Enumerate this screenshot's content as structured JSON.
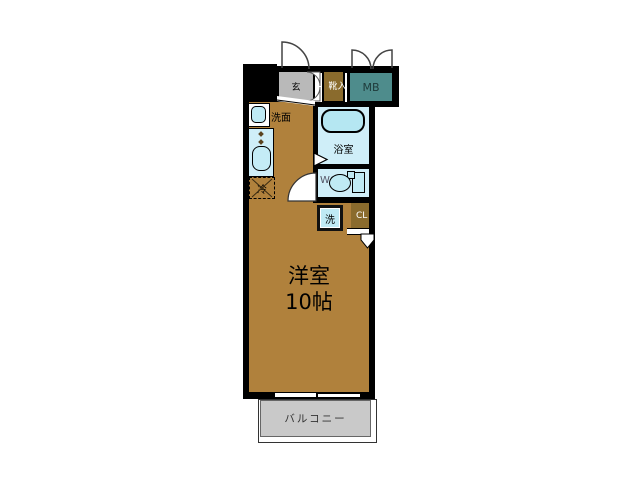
{
  "plan": {
    "type": "apartment-floor-plan",
    "rooms": {
      "entrance": {
        "label": "玄"
      },
      "shoe_cabinet": {
        "label": "靴入"
      },
      "meter_box": {
        "label": "MB"
      },
      "washstand": {
        "label": "洗面"
      },
      "bathroom": {
        "label": "浴室"
      },
      "toilet": {
        "label": "WC"
      },
      "washer": {
        "label": "洗"
      },
      "closet": {
        "label": "CL"
      },
      "refrigerator": {
        "label": "冷"
      },
      "main_room": {
        "label": "洋室",
        "size_label": "10帖"
      },
      "balcony": {
        "label": "バルコニー"
      }
    },
    "colors": {
      "room_brown": "#b0813c",
      "dark_brown": "#8a6b2d",
      "meter_box_teal": "#4e8c8c",
      "entrance_gray": "#b9b9b9",
      "room_light_blue": "#cfeef8",
      "fixture_blue": "#bfeaf4",
      "balcony_gray": "#c9c9c9",
      "wall": "#000000",
      "background": "#ffffff"
    }
  }
}
